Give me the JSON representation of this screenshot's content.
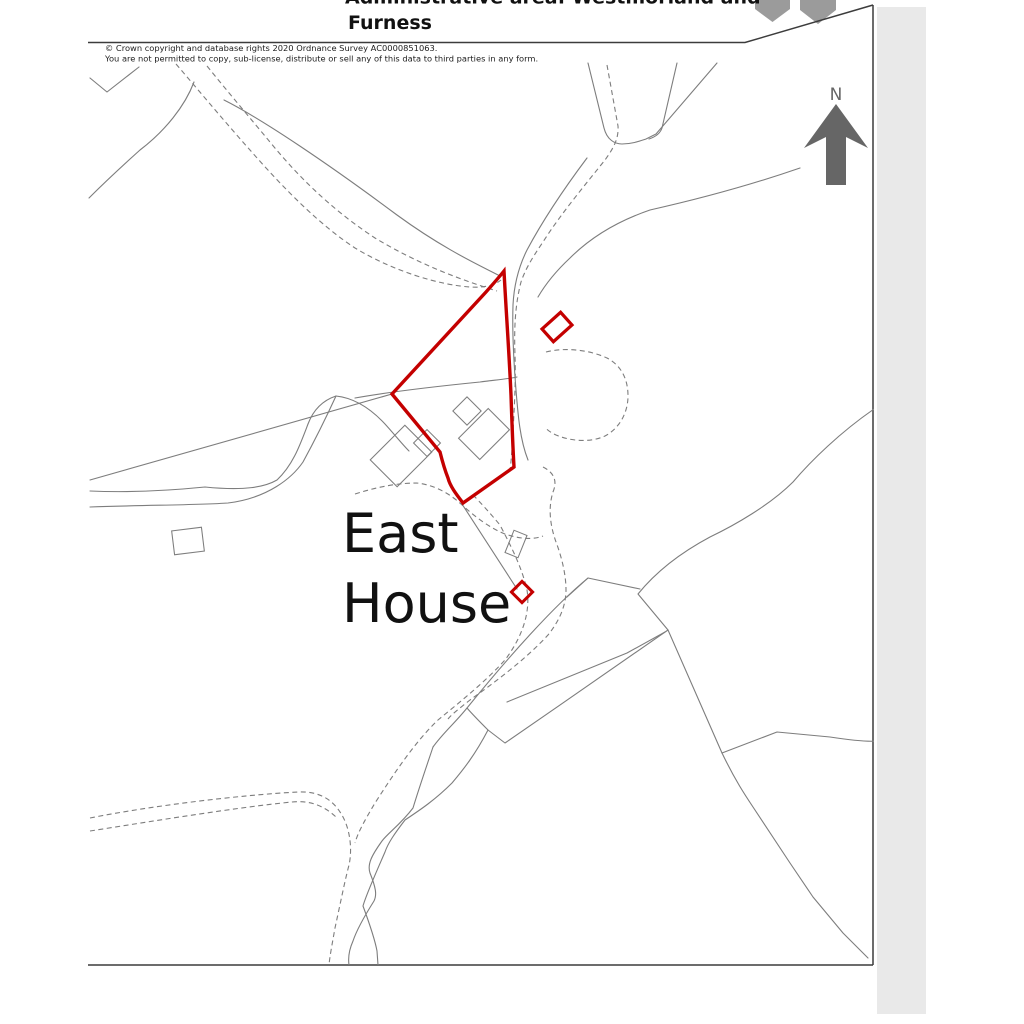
{
  "page": {
    "title_block": {
      "line1_partial": "Administrative area: Westmorland and",
      "line2": "Furness"
    },
    "copyright_line1": "© Crown copyright and database rights 2020 Ordnance Survey AC0000851063.",
    "copyright_line2": "You are not permitted to copy, sub-license, distribute or sell any of this data to third parties in any form.",
    "map_label_line1": "East",
    "map_label_line2": "House",
    "compass_label": "N"
  },
  "icons": {
    "north_arrow": "north-arrow-icon",
    "logo_partial": "crest-logo-partial-icon"
  },
  "colors": {
    "parcel_boundary_red": "#c40000",
    "map_line_gray": "#7d7d7d",
    "compass_gray": "#666666",
    "logo_gray": "#9b9b9b",
    "border_dark": "#3c3c3c",
    "page_edge_gray": "#e9e9e9",
    "text_black": "#111111"
  }
}
